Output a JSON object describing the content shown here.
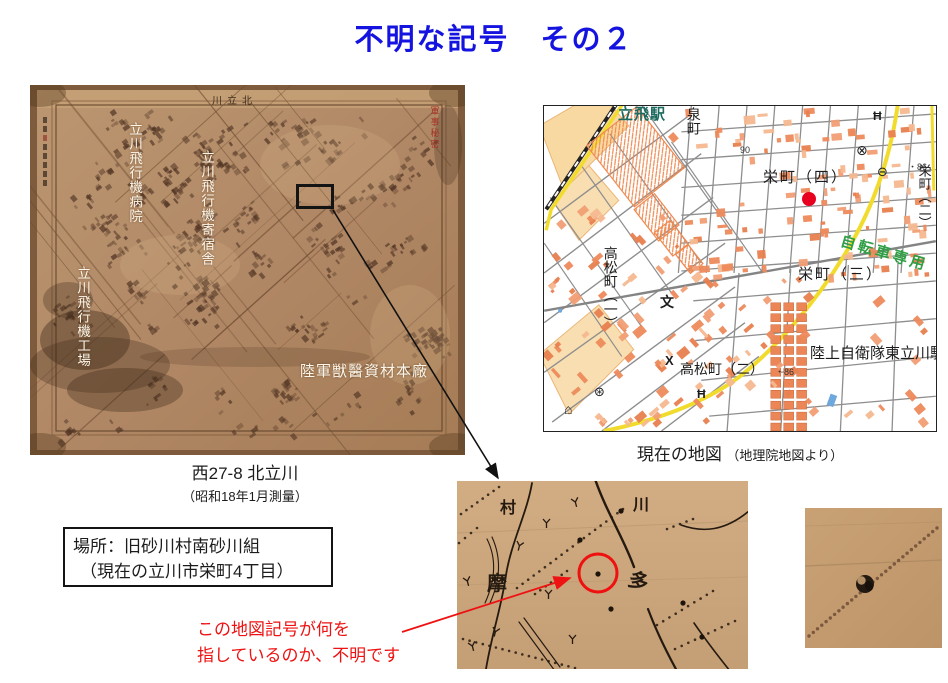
{
  "slide": {
    "title": "不明な記号　その２"
  },
  "colors": {
    "title": "#1413e0",
    "red": "#ee1212",
    "highlight": "#e8001f",
    "bike": "#2f9e44",
    "station": "#1d6b60"
  },
  "old_map": {
    "sheet_title": "川立北",
    "secret_stamp": "軍事秘密",
    "label_hospital": "立川飛行機病院",
    "label_dormitory": "立川飛行機寄宿舎",
    "label_factory": "立川飛行機工場",
    "label_depot": "陸軍獣醫資材本廠",
    "caption": "西27-8 北立川",
    "caption_sub": "（昭和18年1月測量）"
  },
  "modern_map": {
    "caption": "現在の地図",
    "caption_sub": "（地理院地図より）",
    "station": "立飛駅",
    "izumicho": "泉町",
    "sakaecho4": "栄町（四）",
    "sakaecho2": "栄町（二）",
    "sakaecho3": "栄町（三）",
    "takamatsu1": "高松町（一）",
    "takamatsu2": "高松町（二）",
    "jsdf": "陸上自衛隊東立川駐",
    "bike_road": "自転車専用",
    "elev90": "90",
    "elev86a": "・86",
    "elev86b": "・86",
    "icons": {
      "police": "⊗",
      "bus": "⊖",
      "school": "文",
      "koban": "X",
      "shrine": "Ħ",
      "shrine2": "Ħ",
      "hut": "⌂",
      "mill": "⊛"
    }
  },
  "location_box": {
    "line1": "場所：旧砂川村南砂川組",
    "line2": "（現在の立川市栄町4丁目）"
  },
  "annotation": {
    "line1": "この地図記号が何を",
    "line2": "指しているのか、不明です"
  },
  "crop": {
    "char_mura": "村",
    "char_kawa": "川",
    "char_ma": "摩",
    "char_ta": "多"
  }
}
